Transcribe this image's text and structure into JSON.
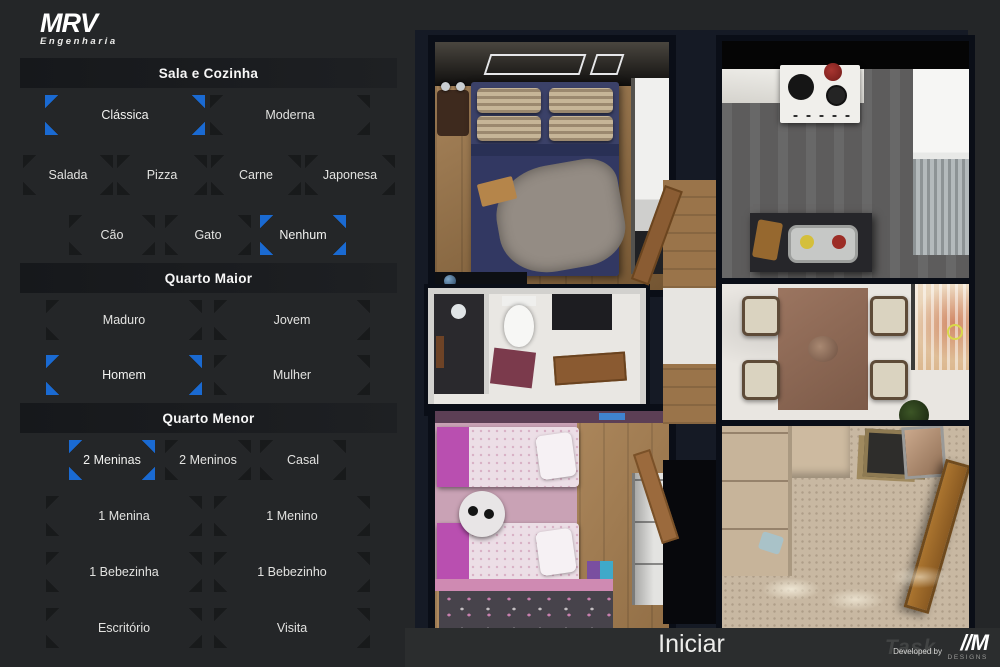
{
  "brand": {
    "name": "MRV",
    "subtitle": "Engenharia"
  },
  "colors": {
    "accent_blue": "#1a6ad2",
    "panel_bg": "#242628",
    "header_bg": "#17191c",
    "plan_backdrop": "#151a25",
    "footer_bg": "#2b2d2e"
  },
  "sections": [
    {
      "title": "Sala e Cozinha",
      "style": [
        {
          "label": "Clássica",
          "selected": true
        },
        {
          "label": "Moderna",
          "selected": false
        }
      ],
      "food": [
        {
          "label": "Salada"
        },
        {
          "label": "Pizza"
        },
        {
          "label": "Carne"
        },
        {
          "label": "Japonesa"
        }
      ],
      "pet": [
        {
          "label": "Cão"
        },
        {
          "label": "Gato"
        },
        {
          "label": "Nenhum",
          "selected": true
        }
      ]
    },
    {
      "title": "Quarto Maior",
      "age": [
        {
          "label": "Maduro"
        },
        {
          "label": "Jovem"
        }
      ],
      "gender": [
        {
          "label": "Homem",
          "selected": true
        },
        {
          "label": "Mulher"
        }
      ]
    },
    {
      "title": "Quarto Menor",
      "occupants": [
        {
          "label": "2 Meninas",
          "selected": true
        },
        {
          "label": "2 Meninos"
        },
        {
          "label": "Casal"
        }
      ],
      "single": [
        {
          "label": "1 Menina"
        },
        {
          "label": "1 Menino"
        }
      ],
      "baby": [
        {
          "label": "1 Bebezinha"
        },
        {
          "label": "1 Bebezinho"
        }
      ],
      "other": [
        {
          "label": "Escritório"
        },
        {
          "label": "Visita"
        }
      ]
    }
  ],
  "floorplan": {
    "rooms": [
      "master-bedroom",
      "bathroom",
      "kids-bedroom",
      "kitchen",
      "dining",
      "living-entry",
      "hallway"
    ]
  },
  "footer": {
    "start_label": "Iniciar",
    "developed_by": "Developed by",
    "developer": "//M",
    "developer_sub": "DESIGNS",
    "watermark": "Task"
  }
}
